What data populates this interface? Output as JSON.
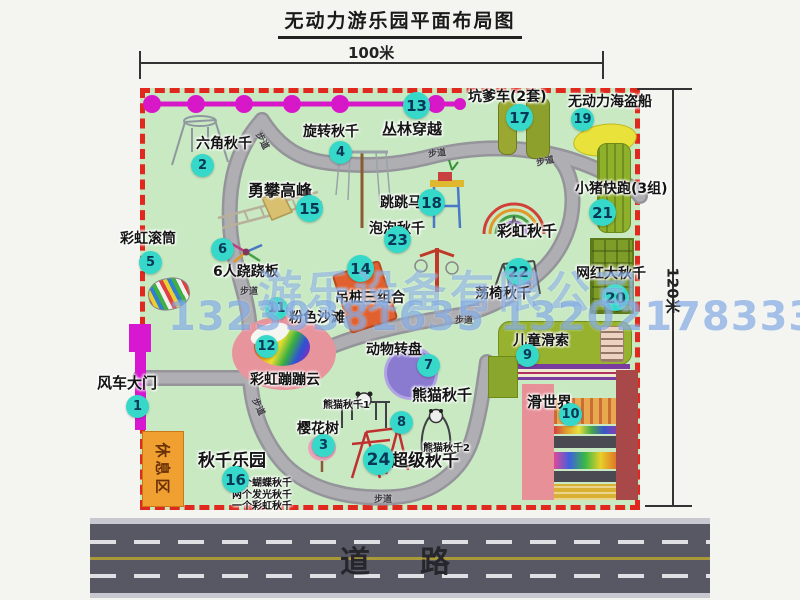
{
  "title": "无动力游乐园平面布局图",
  "dimensions": {
    "width": "100米",
    "height": "120米"
  },
  "road_label": "道　路",
  "walkway_label": "步道",
  "rest_area_label": "休息区",
  "watermark": {
    "company": "游乐设备有限公司",
    "phone": "13239381635 13202178333"
  },
  "extra_labels": {
    "rainbow_swing": "彩虹秋千",
    "panda_swing_1": "熊猫秋千1",
    "panda_swing_2": "熊猫秋千2"
  },
  "swing_park_details": [
    "两个蝴蝶秋千",
    "两个发光秋千",
    "一个彩虹秋千"
  ],
  "attractions": [
    {
      "num": 1,
      "name": "风车大门"
    },
    {
      "num": 2,
      "name": "六角秋千"
    },
    {
      "num": 3,
      "name": "樱花树"
    },
    {
      "num": 4,
      "name": "旋转秋千"
    },
    {
      "num": 5,
      "name": "彩虹滚筒"
    },
    {
      "num": 6,
      "name": "6人跷跷板"
    },
    {
      "num": 7,
      "name": "动物转盘"
    },
    {
      "num": 8,
      "name": "熊猫秋千"
    },
    {
      "num": 9,
      "name": "儿童滑索"
    },
    {
      "num": 10,
      "name": "滑世界"
    },
    {
      "num": 11,
      "name": "粉色沙滩"
    },
    {
      "num": 12,
      "name": "彩虹蹦蹦云"
    },
    {
      "num": 13,
      "name": "丛林穿越"
    },
    {
      "num": 14,
      "name": "吊桩三组合"
    },
    {
      "num": 15,
      "name": "勇攀高峰"
    },
    {
      "num": 16,
      "name": "秋千乐园"
    },
    {
      "num": 17,
      "name": "坑爹车(2套)"
    },
    {
      "num": 18,
      "name": "跳跳马"
    },
    {
      "num": 19,
      "name": "无动力海盗船"
    },
    {
      "num": 20,
      "name": "网红大秋千"
    },
    {
      "num": 21,
      "name": "小猪快跑(3组)"
    },
    {
      "num": 22,
      "name": "荡椅秋千"
    },
    {
      "num": 23,
      "name": "泡泡秋千"
    },
    {
      "num": 24,
      "name": "超级秋千"
    }
  ],
  "colors": {
    "map_green": "#c8e9c2",
    "border_red": "#e0281e",
    "badge_teal": "#35d8c9",
    "zipline_magenta": "#d818c8",
    "road_gray": "#585864",
    "rest_area_orange": "#f0a030"
  }
}
